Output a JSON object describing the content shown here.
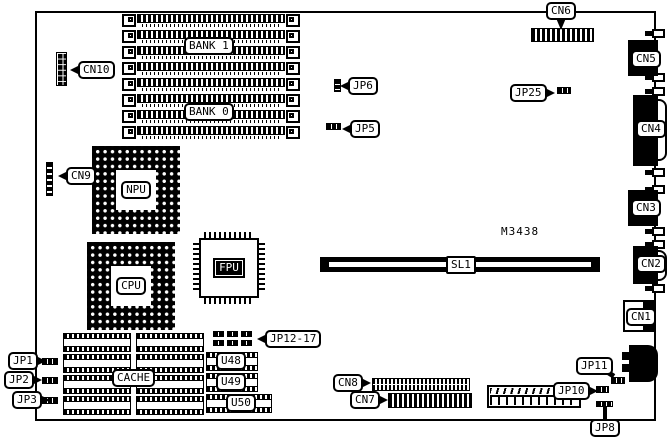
{
  "board": {
    "part_number": "M3438",
    "memory": {
      "bank1": "BANK 1",
      "bank0": "BANK 0"
    },
    "chips": {
      "npu": "NPU",
      "cpu": "CPU",
      "fpu": "FPU",
      "cache": "CACHE",
      "u48": "U48",
      "u49": "U49",
      "u50": "U50"
    },
    "slot": {
      "sl1": "SL1"
    },
    "connectors": {
      "cn1": "CN1",
      "cn2": "CN2",
      "cn3": "CN3",
      "cn4": "CN4",
      "cn5": "CN5",
      "cn6": "CN6",
      "cn7": "CN7",
      "cn8": "CN8",
      "cn9": "CN9",
      "cn10": "CN10"
    },
    "jumpers": {
      "jp1": "JP1",
      "jp2": "JP2",
      "jp3": "JP3",
      "jp5": "JP5",
      "jp6": "JP6",
      "jp8": "JP8",
      "jp10": "JP10",
      "jp11": "JP11",
      "jp12_17": "JP12-17",
      "jp25": "JP25"
    }
  },
  "colors": {
    "ink": "#000000",
    "paper": "#ffffff"
  }
}
